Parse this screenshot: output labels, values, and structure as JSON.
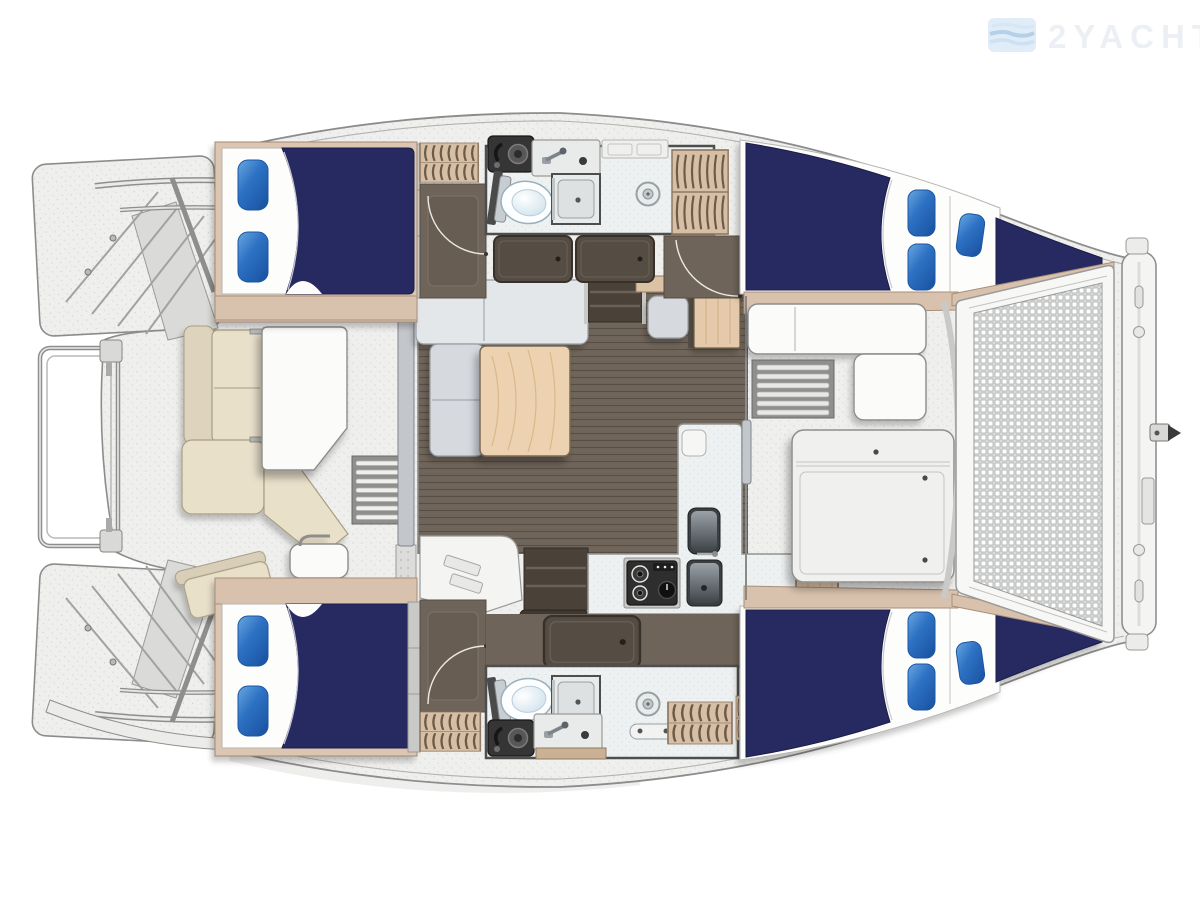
{
  "watermark": {
    "text": "2YACHTS",
    "logo": "flag-logo"
  },
  "diagram": {
    "type": "yacht-floor-plan",
    "subject": "catamaran deck and accommodation layout, bow to the right",
    "features": [
      "4 double berths with blue pillows",
      "2 bathrooms with toilet, shower, sink",
      "salon with L-sofa and wood table",
      "L-shaped galley with stove and double sink",
      "aft cockpit with U-settee and table",
      "forward cockpit lounge",
      "bow trampoline mesh",
      "stern rail and transom steps",
      "forward crossbeam with forestay fitting"
    ]
  },
  "colors": {
    "navy": "#262a60",
    "navyEdge": "#1b1e46",
    "pillowLight": "#6aa7e0",
    "pillowMid": "#2e72c4",
    "pillowDark": "#1c55a4",
    "beigeCushion": "#e9e0ca",
    "cushionEdge": "#a89d85",
    "beigeTrim": "#d9c2ad",
    "trimEdge": "#a78f79",
    "lockerBeige": "#d7bfa6",
    "lockerStripe": "#6d5b49",
    "wood": "#e4caaa",
    "woodLight": "#ecd2b0",
    "woodGrain": "#d9b88b",
    "floor": "#6f6459",
    "plankLine": "#574e45",
    "floorDark": "#584f46",
    "deck": "#efefed",
    "deckDot": "#d6d6d4",
    "bath": "#eef1f1",
    "wall": "#4e4e4e",
    "meshLine": "#a6aaab",
    "sofa": "#e4e7ea",
    "sofaSeat": "#d6dadf",
    "sofaEdge": "#979da3",
    "white": "#fbfbfa",
    "outline": "#8c8c8c",
    "stoveDark": "#2e2e2e",
    "sinkDark": "#353535",
    "steel": "#9a9a98",
    "watermark": "#e9edf2",
    "logoBlue": "#c6dcf0",
    "logoBlueDeep": "#a9c9e6"
  }
}
